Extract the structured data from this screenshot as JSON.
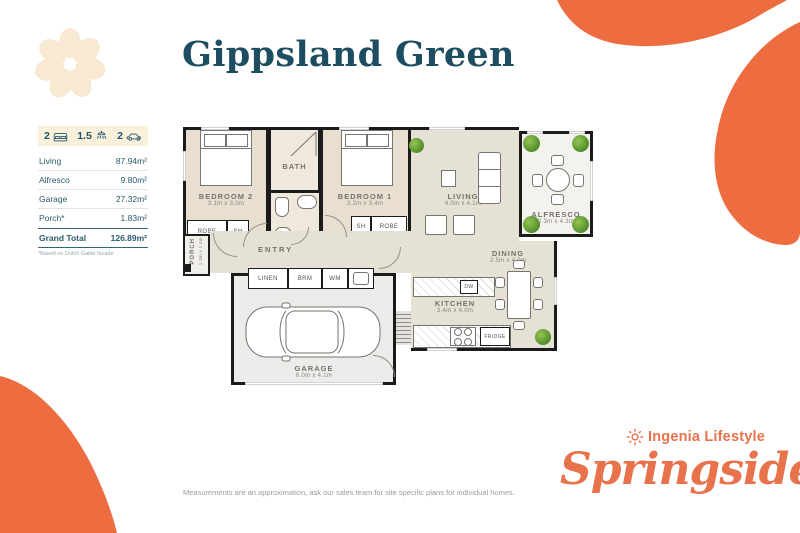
{
  "title": "Gippsland Green",
  "stats": {
    "beds": "2",
    "baths": "1.5",
    "cars": "2"
  },
  "areas": {
    "rows": [
      {
        "label": "Living",
        "value": "87.94m²"
      },
      {
        "label": "Alfresco",
        "value": "9.80m²"
      },
      {
        "label": "Garage",
        "value": "27.32m²"
      },
      {
        "label": "Porch*",
        "value": "1.83m²"
      }
    ],
    "total_label": "Grand Total",
    "total_value": "126.89m²",
    "footnote": "*Based on Dutch Gable facade"
  },
  "plan": {
    "bedroom2": {
      "name": "BEDROOM 2",
      "dims": "3.1m x 3.0m"
    },
    "bedroom1": {
      "name": "BEDROOM 1",
      "dims": "3.2m x 3.4m"
    },
    "bath": {
      "name": "BATH"
    },
    "wc": {
      "name": "WC"
    },
    "living": {
      "name": "LIVING",
      "dims": "4.0m x 4.1m"
    },
    "alfresco": {
      "name": "ALFRESCO",
      "dims": "2.3m x 4.3m"
    },
    "dining": {
      "name": "DINING",
      "dims": "2.5m x 4.0m"
    },
    "kitchen": {
      "name": "KITCHEN",
      "dims": "3.4m x 4.0m"
    },
    "garage": {
      "name": "GARAGE",
      "dims": "6.0m x 4.1m"
    },
    "entry": {
      "name": "ENTRY"
    },
    "porch": {
      "name": "PORCH",
      "dims": "1.3m x 1.4m"
    },
    "fixtures": {
      "robe": "ROBE",
      "sh": "SH",
      "linen": "LINEN",
      "brm": "BRM",
      "wm": "WM",
      "dw": "DW",
      "fridge": "FRIDGE"
    }
  },
  "footer": {
    "disclaimer": "Measurements are an approximation, ask our sales team for site specific plans for individual homes.",
    "brand": "Ingenia Lifestyle",
    "community": "Springside"
  },
  "colors": {
    "accent_orange": "#ED6C40",
    "brand_teal": "#1D4D61",
    "cream": "#F8E9D2"
  }
}
